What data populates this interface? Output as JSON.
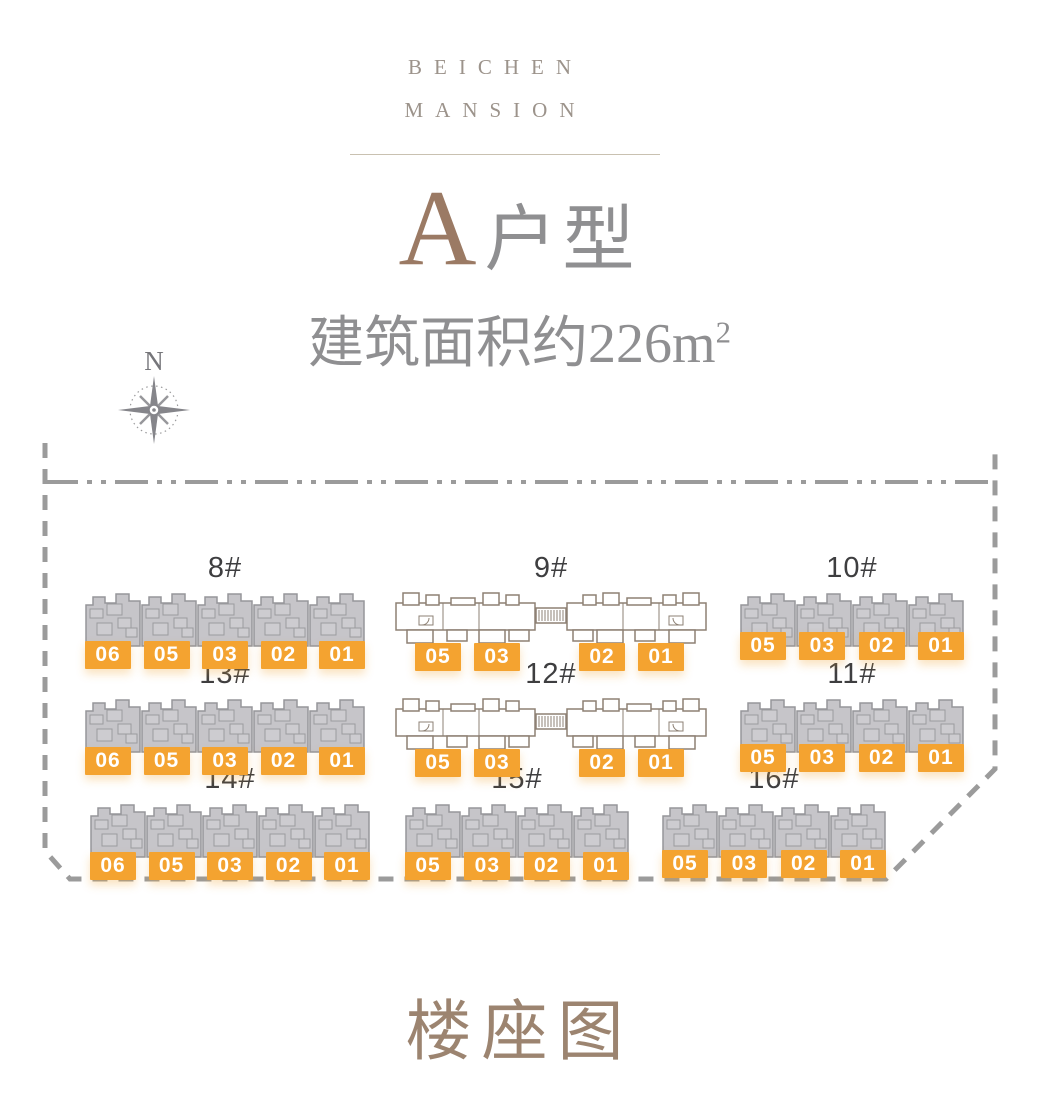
{
  "brand": {
    "line1": "BEICHEN",
    "line2": "MANSION"
  },
  "title": {
    "letter": "A",
    "suffix": "户型"
  },
  "subtitle": {
    "text": "建筑面积约226m",
    "sup": "2"
  },
  "compass": {
    "label": "N"
  },
  "footer_title": "楼座图",
  "colors": {
    "accent_orange": "#F4A330",
    "title_brown": "#9B7A64",
    "footer_brown": "#9C8470",
    "brand_color": "#9C938B",
    "divider_color": "#C9C1B1",
    "text_gray": "#8F8F91",
    "name_color": "#3E3E40",
    "building_fill": "#C6C5C9",
    "building_stroke": "#96969A",
    "plan_outline": "#8D8074",
    "boundary_gray": "#9B9B9B"
  },
  "buildings": {
    "b8": {
      "name": "8#",
      "units": [
        "06",
        "05",
        "03",
        "02",
        "01"
      ]
    },
    "b9": {
      "name": "9#",
      "units": [
        "05",
        "03",
        "02",
        "01"
      ]
    },
    "b10": {
      "name": "10#",
      "units": [
        "05",
        "03",
        "02",
        "01"
      ]
    },
    "b13": {
      "name": "13#",
      "units": [
        "06",
        "05",
        "03",
        "02",
        "01"
      ]
    },
    "b12": {
      "name": "12#",
      "units": [
        "05",
        "03",
        "02",
        "01"
      ]
    },
    "b11": {
      "name": "11#",
      "units": [
        "05",
        "03",
        "02",
        "01"
      ]
    },
    "b14": {
      "name": "14#",
      "units": [
        "06",
        "05",
        "03",
        "02",
        "01"
      ]
    },
    "b15": {
      "name": "15#",
      "units": [
        "05",
        "03",
        "02",
        "01"
      ]
    },
    "b16": {
      "name": "16#",
      "units": [
        "05",
        "03",
        "02",
        "01"
      ]
    }
  }
}
